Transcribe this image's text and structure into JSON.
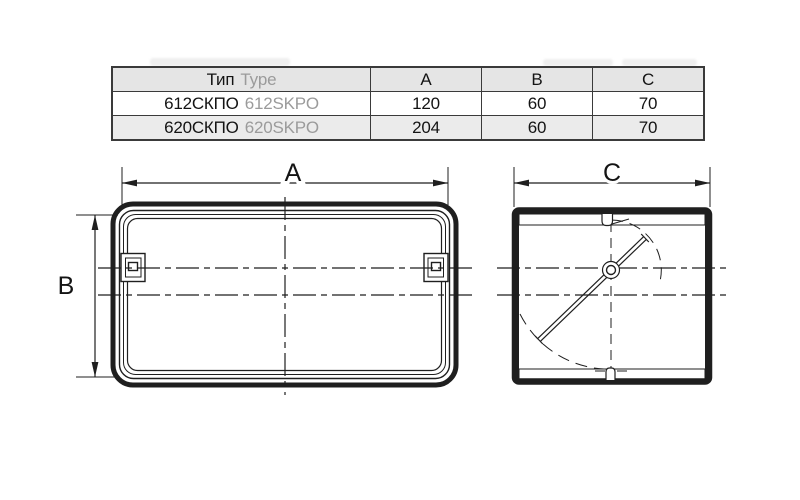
{
  "colors": {
    "line": "#1f1f1f",
    "table_border": "#3a3a3a",
    "header_bg": "#e5e5e5",
    "row_alt_bg": "#ebebeb",
    "secondary_text": "#9b9b9b",
    "primary_text": "#141414"
  },
  "table": {
    "columns": {
      "type_ru": "Тип",
      "type_en": "Type",
      "a": "A",
      "b": "B",
      "c": "C"
    },
    "rows": [
      {
        "type_ru": "612СКПО",
        "type_en": "612SKPO",
        "a": "120",
        "b": "60",
        "c": "70"
      },
      {
        "type_ru": "620СКПО",
        "type_en": "620SKPO",
        "a": "204",
        "b": "60",
        "c": "70"
      }
    ]
  },
  "drawing": {
    "front_view": {
      "width_label": "A",
      "height_label": "B"
    },
    "side_view": {
      "depth_label": "C"
    }
  }
}
